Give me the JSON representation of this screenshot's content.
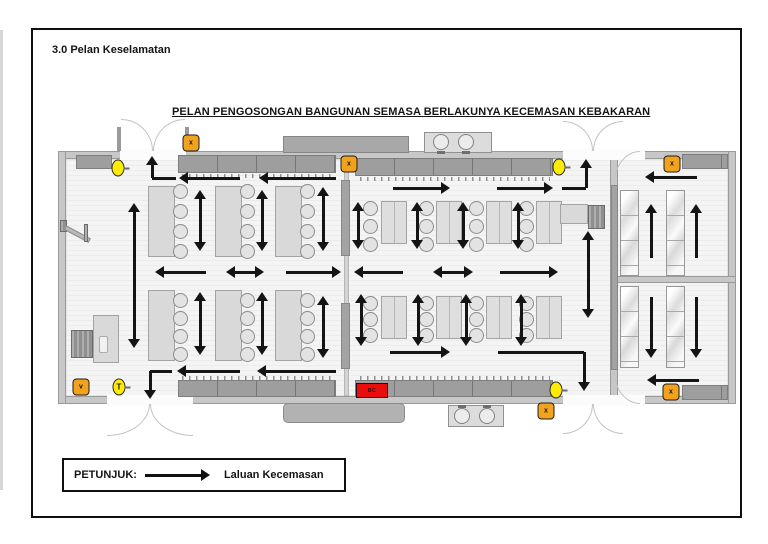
{
  "page": {
    "section_heading": "3.0 Pelan Keselamatan",
    "title": "PELAN PENGOSONGAN BANGUNAN SEMASA BERLAKUNYA KECEMASAN KEBAKARAN"
  },
  "legend": {
    "label": "PETUNJUK:",
    "arrow_meaning": "Laluan Kecemasan"
  },
  "colors": {
    "exit_marker_orange": "#F2A21D",
    "lamp_marker_yellow": "#FFEC00",
    "alarm_red": "#EA0D0D",
    "route_arrow_black": "#141414",
    "wall_gray": "#c7c7c7",
    "cabinet_gray": "#9e9e9e"
  },
  "plan": {
    "alarm": {
      "label": "BC",
      "x": 356,
      "y": 383,
      "w": 32,
      "h": 15
    },
    "markers": [
      {
        "shape": "square",
        "label": "x",
        "cx": 191,
        "cy": 143
      },
      {
        "shape": "square",
        "label": "x",
        "cx": 349,
        "cy": 164
      },
      {
        "shape": "square",
        "label": "x",
        "cx": 672,
        "cy": 164
      },
      {
        "shape": "square",
        "label": "x",
        "cx": 546,
        "cy": 411
      },
      {
        "shape": "square",
        "label": "x",
        "cx": 671,
        "cy": 392
      },
      {
        "shape": "square",
        "label": "v",
        "cx": 81,
        "cy": 387
      },
      {
        "shape": "circle",
        "label": "",
        "cx": 118,
        "cy": 168
      },
      {
        "shape": "circle",
        "label": "",
        "cx": 559,
        "cy": 167
      },
      {
        "shape": "circle",
        "label": "",
        "cx": 556,
        "cy": 390
      },
      {
        "shape": "circle",
        "label": "T",
        "cx": 119,
        "cy": 387
      }
    ],
    "chairs": [
      [
        173,
        184
      ],
      [
        173,
        204
      ],
      [
        173,
        224
      ],
      [
        173,
        244
      ],
      [
        240,
        184
      ],
      [
        240,
        204
      ],
      [
        240,
        224
      ],
      [
        240,
        244
      ],
      [
        300,
        184
      ],
      [
        300,
        204
      ],
      [
        300,
        224
      ],
      [
        300,
        244
      ],
      [
        173,
        293
      ],
      [
        173,
        311
      ],
      [
        173,
        329
      ],
      [
        173,
        347
      ],
      [
        240,
        293
      ],
      [
        240,
        311
      ],
      [
        240,
        329
      ],
      [
        240,
        347
      ],
      [
        300,
        293
      ],
      [
        300,
        311
      ],
      [
        300,
        329
      ],
      [
        300,
        347
      ],
      [
        363,
        201
      ],
      [
        363,
        219
      ],
      [
        363,
        237
      ],
      [
        419,
        201
      ],
      [
        419,
        219
      ],
      [
        419,
        237
      ],
      [
        469,
        201
      ],
      [
        469,
        219
      ],
      [
        469,
        237
      ],
      [
        519,
        201
      ],
      [
        519,
        219
      ],
      [
        519,
        237
      ],
      [
        363,
        296
      ],
      [
        363,
        312
      ],
      [
        363,
        328
      ],
      [
        419,
        296
      ],
      [
        419,
        312
      ],
      [
        419,
        328
      ],
      [
        469,
        296
      ],
      [
        469,
        312
      ],
      [
        469,
        328
      ],
      [
        519,
        296
      ],
      [
        519,
        312
      ],
      [
        519,
        328
      ]
    ],
    "items": [
      {
        "c": "floor",
        "x": 66,
        "y": 159,
        "w": 662,
        "h": 237
      },
      {
        "c": "wall",
        "x": 58,
        "y": 151,
        "w": 678,
        "h": 8
      },
      {
        "c": "wall",
        "x": 58,
        "y": 396,
        "w": 678,
        "h": 8
      },
      {
        "c": "wall",
        "x": 58,
        "y": 151,
        "w": 8,
        "h": 253
      },
      {
        "c": "wall",
        "x": 728,
        "y": 151,
        "w": 8,
        "h": 253
      },
      {
        "c": "wall",
        "x": 610,
        "y": 159,
        "w": 8,
        "h": 240
      },
      {
        "c": "wallthin",
        "x": 344,
        "y": 159,
        "w": 5,
        "h": 237
      },
      {
        "c": "wall",
        "x": 612,
        "y": 276,
        "w": 124,
        "h": 7
      },
      {
        "c": "wseg",
        "x": 341,
        "y": 180,
        "w": 9,
        "h": 76
      },
      {
        "c": "wseg",
        "x": 341,
        "y": 303,
        "w": 9,
        "h": 66
      },
      {
        "c": "wseg",
        "x": 611,
        "y": 185,
        "w": 7,
        "h": 185
      },
      {
        "c": "gap",
        "x": 120,
        "y": 149,
        "w": 66,
        "h": 11
      },
      {
        "c": "gap",
        "x": 563,
        "y": 149,
        "w": 60,
        "h": 11
      },
      {
        "c": "gap",
        "x": 613,
        "y": 149,
        "w": 32,
        "h": 11
      },
      {
        "c": "gap",
        "x": 107,
        "y": 395,
        "w": 86,
        "h": 11
      },
      {
        "c": "gap",
        "x": 563,
        "y": 395,
        "w": 60,
        "h": 11
      },
      {
        "c": "gap",
        "x": 613,
        "y": 395,
        "w": 32,
        "h": 11
      },
      {
        "c": "arcTR",
        "x": 121,
        "y": 119,
        "w": 32,
        "h": 32
      },
      {
        "c": "arcTL",
        "x": 153,
        "y": 119,
        "w": 32,
        "h": 32
      },
      {
        "c": "post",
        "x": 117,
        "y": 127,
        "w": 4,
        "h": 24
      },
      {
        "c": "post",
        "x": 185,
        "y": 127,
        "w": 4,
        "h": 24
      },
      {
        "c": "arcTR",
        "x": 563,
        "y": 121,
        "w": 30,
        "h": 30
      },
      {
        "c": "arcTL",
        "x": 593,
        "y": 121,
        "w": 30,
        "h": 30
      },
      {
        "c": "arcBR",
        "x": 107,
        "y": 404,
        "w": 43,
        "h": 32
      },
      {
        "c": "arcBL",
        "x": 150,
        "y": 404,
        "w": 43,
        "h": 32
      },
      {
        "c": "arcBR",
        "x": 563,
        "y": 404,
        "w": 30,
        "h": 30
      },
      {
        "c": "arcBL",
        "x": 593,
        "y": 404,
        "w": 30,
        "h": 30
      },
      {
        "c": "arcTL",
        "x": 614,
        "y": 151,
        "w": 26,
        "h": 32
      },
      {
        "c": "arcBL",
        "x": 614,
        "y": 372,
        "w": 26,
        "h": 32
      },
      {
        "c": "cab",
        "x": 76,
        "y": 155,
        "w": 36,
        "h": 14
      },
      {
        "c": "cab",
        "x": 178,
        "y": 155,
        "w": 158,
        "h": 18
      },
      {
        "c": "pegs",
        "x": 182,
        "y": 174,
        "w": 150,
        "h": 4
      },
      {
        "c": "cab",
        "x": 355,
        "y": 158,
        "w": 198,
        "h": 18
      },
      {
        "c": "pegs",
        "x": 360,
        "y": 177,
        "w": 190,
        "h": 4
      },
      {
        "c": "cabx",
        "x": 283,
        "y": 136,
        "w": 126,
        "h": 17
      },
      {
        "c": "cab",
        "x": 178,
        "y": 380,
        "w": 158,
        "h": 17
      },
      {
        "c": "pegs",
        "x": 182,
        "y": 376,
        "w": 150,
        "h": 4
      },
      {
        "c": "cab",
        "x": 355,
        "y": 380,
        "w": 198,
        "h": 17
      },
      {
        "c": "pegs",
        "x": 360,
        "y": 376,
        "w": 190,
        "h": 4
      },
      {
        "c": "cabr",
        "x": 283,
        "y": 403,
        "w": 122,
        "h": 20
      },
      {
        "c": "cab",
        "x": 682,
        "y": 154,
        "w": 46,
        "h": 15
      },
      {
        "c": "cab",
        "x": 682,
        "y": 385,
        "w": 46,
        "h": 15
      },
      {
        "c": "sink",
        "x": 424,
        "y": 132,
        "w": 68,
        "h": 21
      },
      {
        "c": "basin",
        "x": 433,
        "y": 134,
        "w": 16,
        "h": 16
      },
      {
        "c": "basin",
        "x": 458,
        "y": 134,
        "w": 16,
        "h": 16
      },
      {
        "c": "mark",
        "x": 437,
        "y": 151,
        "w": 8,
        "h": 3
      },
      {
        "c": "mark",
        "x": 462,
        "y": 151,
        "w": 8,
        "h": 3
      },
      {
        "c": "sink",
        "x": 448,
        "y": 405,
        "w": 56,
        "h": 22
      },
      {
        "c": "basin",
        "x": 454,
        "y": 408,
        "w": 16,
        "h": 16
      },
      {
        "c": "basin",
        "x": 479,
        "y": 408,
        "w": 16,
        "h": 16
      },
      {
        "c": "mark",
        "x": 458,
        "y": 405,
        "w": 8,
        "h": 3
      },
      {
        "c": "mark",
        "x": 483,
        "y": 405,
        "w": 8,
        "h": 3
      },
      {
        "c": "table",
        "x": 148,
        "y": 186,
        "w": 27,
        "h": 71
      },
      {
        "c": "table",
        "x": 215,
        "y": 186,
        "w": 27,
        "h": 71
      },
      {
        "c": "table",
        "x": 275,
        "y": 186,
        "w": 27,
        "h": 71
      },
      {
        "c": "table",
        "x": 148,
        "y": 290,
        "w": 27,
        "h": 71
      },
      {
        "c": "table",
        "x": 215,
        "y": 290,
        "w": 27,
        "h": 71
      },
      {
        "c": "table",
        "x": 275,
        "y": 290,
        "w": 27,
        "h": 71
      },
      {
        "c": "table",
        "x": 93,
        "y": 315,
        "w": 26,
        "h": 48
      },
      {
        "c": "slot",
        "x": 99,
        "y": 336,
        "w": 9,
        "h": 17
      },
      {
        "c": "dark",
        "x": 71,
        "y": 330,
        "w": 22,
        "h": 28
      },
      {
        "c": "table2",
        "x": 381,
        "y": 201,
        "w": 26,
        "h": 43
      },
      {
        "c": "table2",
        "x": 436,
        "y": 201,
        "w": 26,
        "h": 43
      },
      {
        "c": "table2",
        "x": 486,
        "y": 201,
        "w": 26,
        "h": 43
      },
      {
        "c": "table2",
        "x": 536,
        "y": 201,
        "w": 26,
        "h": 43
      },
      {
        "c": "table2",
        "x": 381,
        "y": 296,
        "w": 26,
        "h": 43
      },
      {
        "c": "table2",
        "x": 436,
        "y": 296,
        "w": 26,
        "h": 43
      },
      {
        "c": "table2",
        "x": 486,
        "y": 296,
        "w": 26,
        "h": 43
      },
      {
        "c": "table2",
        "x": 536,
        "y": 296,
        "w": 26,
        "h": 43
      },
      {
        "c": "table",
        "x": 560,
        "y": 204,
        "w": 28,
        "h": 20
      },
      {
        "c": "dark",
        "x": 588,
        "y": 205,
        "w": 17,
        "h": 24
      },
      {
        "c": "shelf",
        "x": 620,
        "y": 190,
        "w": 19,
        "h": 86
      },
      {
        "c": "shelf",
        "x": 666,
        "y": 190,
        "w": 19,
        "h": 86
      },
      {
        "c": "shelf",
        "x": 620,
        "y": 286,
        "w": 19,
        "h": 82
      },
      {
        "c": "shelf",
        "x": 666,
        "y": 286,
        "w": 19,
        "h": 82
      },
      {
        "c": "dark",
        "x": 60,
        "y": 220,
        "w": 7,
        "h": 12
      },
      {
        "c": "fan",
        "x": 65,
        "y": 225,
        "w": 28,
        "h": 5
      },
      {
        "c": "dark",
        "x": 84,
        "y": 224,
        "w": 4,
        "h": 18
      }
    ],
    "routes": [
      {
        "pts": [
          [
            176,
            178
          ],
          [
            152,
            178
          ],
          [
            152,
            156
          ]
        ],
        "h": "end"
      },
      {
        "pts": [
          [
            240,
            178
          ],
          [
            179,
            178
          ]
        ],
        "h": "end"
      },
      {
        "pts": [
          [
            336,
            178
          ],
          [
            259,
            178
          ]
        ],
        "h": "end"
      },
      {
        "pts": [
          [
            200,
            251
          ],
          [
            200,
            190
          ]
        ],
        "h": "both"
      },
      {
        "pts": [
          [
            262,
            251
          ],
          [
            262,
            190
          ]
        ],
        "h": "both"
      },
      {
        "pts": [
          [
            323,
            251
          ],
          [
            323,
            187
          ]
        ],
        "h": "both"
      },
      {
        "pts": [
          [
            134,
            348
          ],
          [
            134,
            203
          ]
        ],
        "h": "both"
      },
      {
        "pts": [
          [
            200,
            355
          ],
          [
            200,
            292
          ]
        ],
        "h": "both"
      },
      {
        "pts": [
          [
            262,
            355
          ],
          [
            262,
            292
          ]
        ],
        "h": "both"
      },
      {
        "pts": [
          [
            323,
            358
          ],
          [
            323,
            296
          ]
        ],
        "h": "both"
      },
      {
        "pts": [
          [
            206,
            272
          ],
          [
            155,
            272
          ]
        ],
        "h": "end"
      },
      {
        "pts": [
          [
            226,
            272
          ],
          [
            264,
            272
          ]
        ],
        "h": "both"
      },
      {
        "pts": [
          [
            286,
            272
          ],
          [
            341,
            272
          ]
        ],
        "h": "end"
      },
      {
        "pts": [
          [
            240,
            371
          ],
          [
            177,
            371
          ]
        ],
        "h": "end"
      },
      {
        "pts": [
          [
            336,
            371
          ],
          [
            257,
            371
          ]
        ],
        "h": "end"
      },
      {
        "pts": [
          [
            172,
            371
          ],
          [
            150,
            371
          ],
          [
            150,
            399
          ]
        ],
        "h": "end"
      },
      {
        "pts": [
          [
            393,
            188
          ],
          [
            450,
            188
          ]
        ],
        "h": "end"
      },
      {
        "pts": [
          [
            497,
            188
          ],
          [
            553,
            188
          ]
        ],
        "h": "end"
      },
      {
        "pts": [
          [
            562,
            188
          ],
          [
            586,
            188
          ],
          [
            586,
            159
          ]
        ],
        "h": "end"
      },
      {
        "pts": [
          [
            358,
            249
          ],
          [
            358,
            202
          ]
        ],
        "h": "both"
      },
      {
        "pts": [
          [
            417,
            249
          ],
          [
            417,
            202
          ]
        ],
        "h": "both"
      },
      {
        "pts": [
          [
            463,
            249
          ],
          [
            463,
            202
          ]
        ],
        "h": "both"
      },
      {
        "pts": [
          [
            518,
            249
          ],
          [
            518,
            202
          ]
        ],
        "h": "both"
      },
      {
        "pts": [
          [
            361,
            346
          ],
          [
            361,
            294
          ]
        ],
        "h": "both"
      },
      {
        "pts": [
          [
            418,
            346
          ],
          [
            418,
            294
          ]
        ],
        "h": "both"
      },
      {
        "pts": [
          [
            466,
            346
          ],
          [
            466,
            294
          ]
        ],
        "h": "both"
      },
      {
        "pts": [
          [
            521,
            346
          ],
          [
            521,
            294
          ]
        ],
        "h": "both"
      },
      {
        "pts": [
          [
            403,
            272
          ],
          [
            354,
            272
          ]
        ],
        "h": "end"
      },
      {
        "pts": [
          [
            433,
            272
          ],
          [
            473,
            272
          ]
        ],
        "h": "both"
      },
      {
        "pts": [
          [
            500,
            272
          ],
          [
            558,
            272
          ]
        ],
        "h": "end"
      },
      {
        "pts": [
          [
            588,
            318
          ],
          [
            588,
            231
          ]
        ],
        "h": "both"
      },
      {
        "pts": [
          [
            390,
            352
          ],
          [
            450,
            352
          ]
        ],
        "h": "end"
      },
      {
        "pts": [
          [
            498,
            352
          ],
          [
            584,
            352
          ],
          [
            584,
            391
          ]
        ],
        "h": "end"
      },
      {
        "pts": [
          [
            697,
            177
          ],
          [
            645,
            177
          ]
        ],
        "h": "end"
      },
      {
        "pts": [
          [
            651,
            258
          ],
          [
            651,
            204
          ]
        ],
        "h": "end"
      },
      {
        "pts": [
          [
            696,
            258
          ],
          [
            696,
            204
          ]
        ],
        "h": "end"
      },
      {
        "pts": [
          [
            651,
            297
          ],
          [
            651,
            358
          ]
        ],
        "h": "end"
      },
      {
        "pts": [
          [
            696,
            297
          ],
          [
            696,
            358
          ]
        ],
        "h": "end"
      },
      {
        "pts": [
          [
            699,
            380
          ],
          [
            647,
            380
          ]
        ],
        "h": "end"
      }
    ]
  }
}
